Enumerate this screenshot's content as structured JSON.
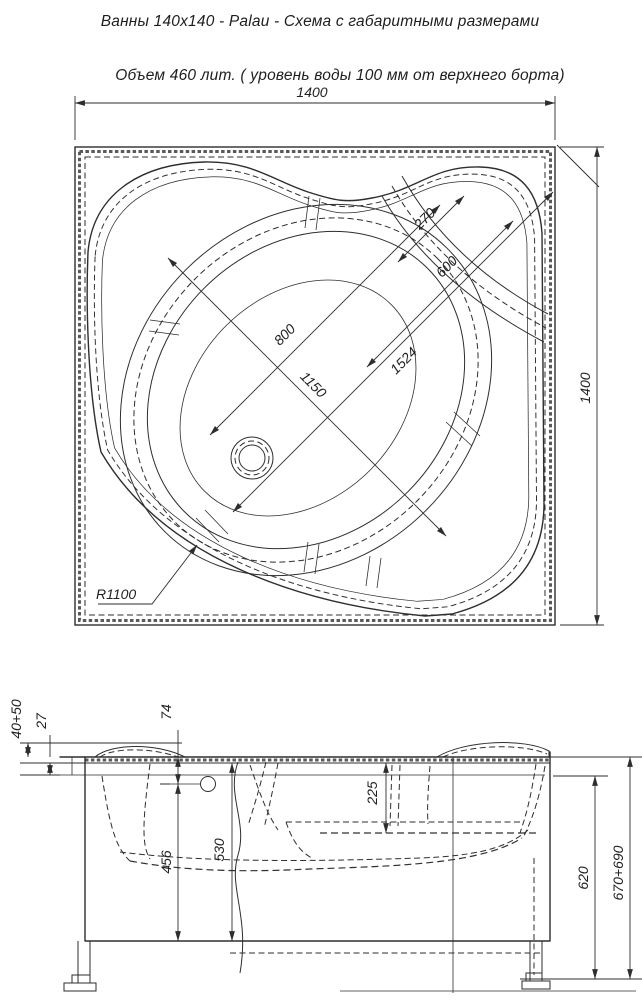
{
  "header": {
    "title": "Ванны 140x140 - Palau - Схема с габаритными размерами",
    "subtitle": "Объем 460 лит. ( уровень воды 100 мм от верхнего борта)"
  },
  "plan_dims": {
    "width_top": "1400",
    "height_right": "1400",
    "seat_270": "270",
    "seat_600": "600",
    "bowl_800": "800",
    "bowl_1150": "1150",
    "diag_1524": "1524",
    "front_radius": "R1100"
  },
  "side_dims": {
    "rim_drop": "40+50",
    "lip": "27",
    "overflow_74": "74",
    "seat_225": "225",
    "depth_456": "456",
    "depth_530": "530",
    "height_620": "620",
    "height_total": "670+690"
  },
  "style": {
    "line_color": "#2e2e2e",
    "background": "#ffffff"
  }
}
